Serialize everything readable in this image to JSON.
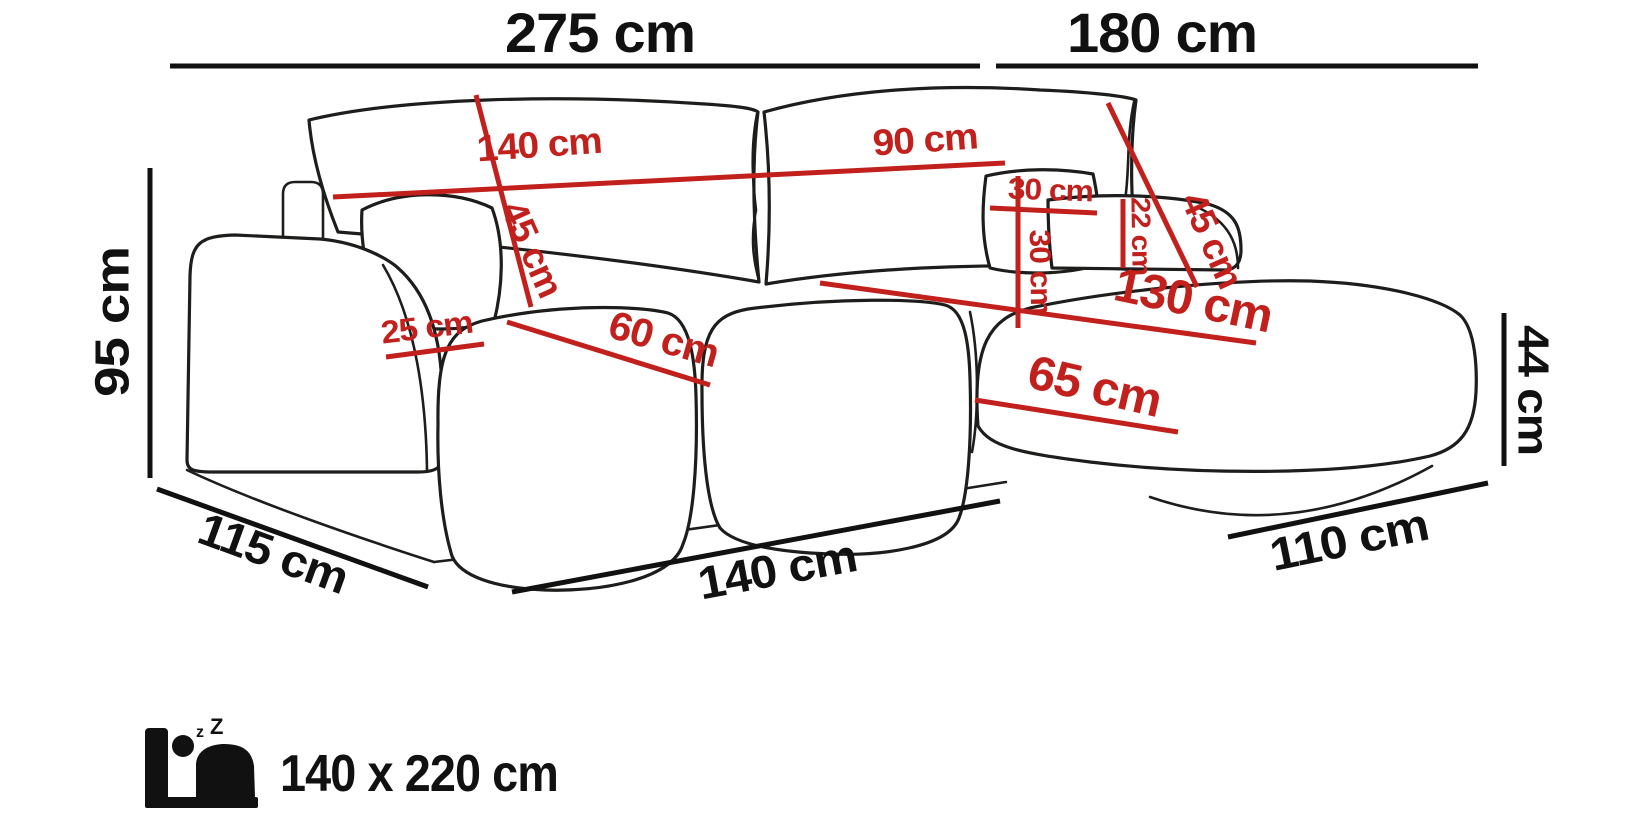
{
  "diagram": {
    "subject": "corner-sofa-dimension-diagram",
    "background": "#ffffff"
  },
  "colors": {
    "sofa_outline": "#1d1d1b",
    "dimension_black": "#111111",
    "dimension_red": "#c1201d"
  },
  "dims": {
    "overall": {
      "back_width": "275 cm",
      "chaise_width": "180 cm",
      "height": "95 cm",
      "side_depth": "115 cm",
      "front_width": "140 cm",
      "chaise_depth": "110 cm",
      "seat_height": "44 cm"
    },
    "details": {
      "back_cushion_left_width": "140 cm",
      "back_cushion_left_height": "45 cm",
      "back_cushion_right_width": "90 cm",
      "back_cushion_right_height": "45 cm",
      "pillow_width": "30 cm",
      "pillow_height": "30 cm",
      "bolster_height": "22 cm",
      "armrest_top_width": "25 cm",
      "seat_depth": "60 cm",
      "chaise_length": "130 cm",
      "chaise_seat_width": "65 cm"
    }
  },
  "sleeping": {
    "icon": "bed-sleep-icon",
    "size": "140 x 220 cm",
    "z_small": "z",
    "z_large": "Z"
  }
}
